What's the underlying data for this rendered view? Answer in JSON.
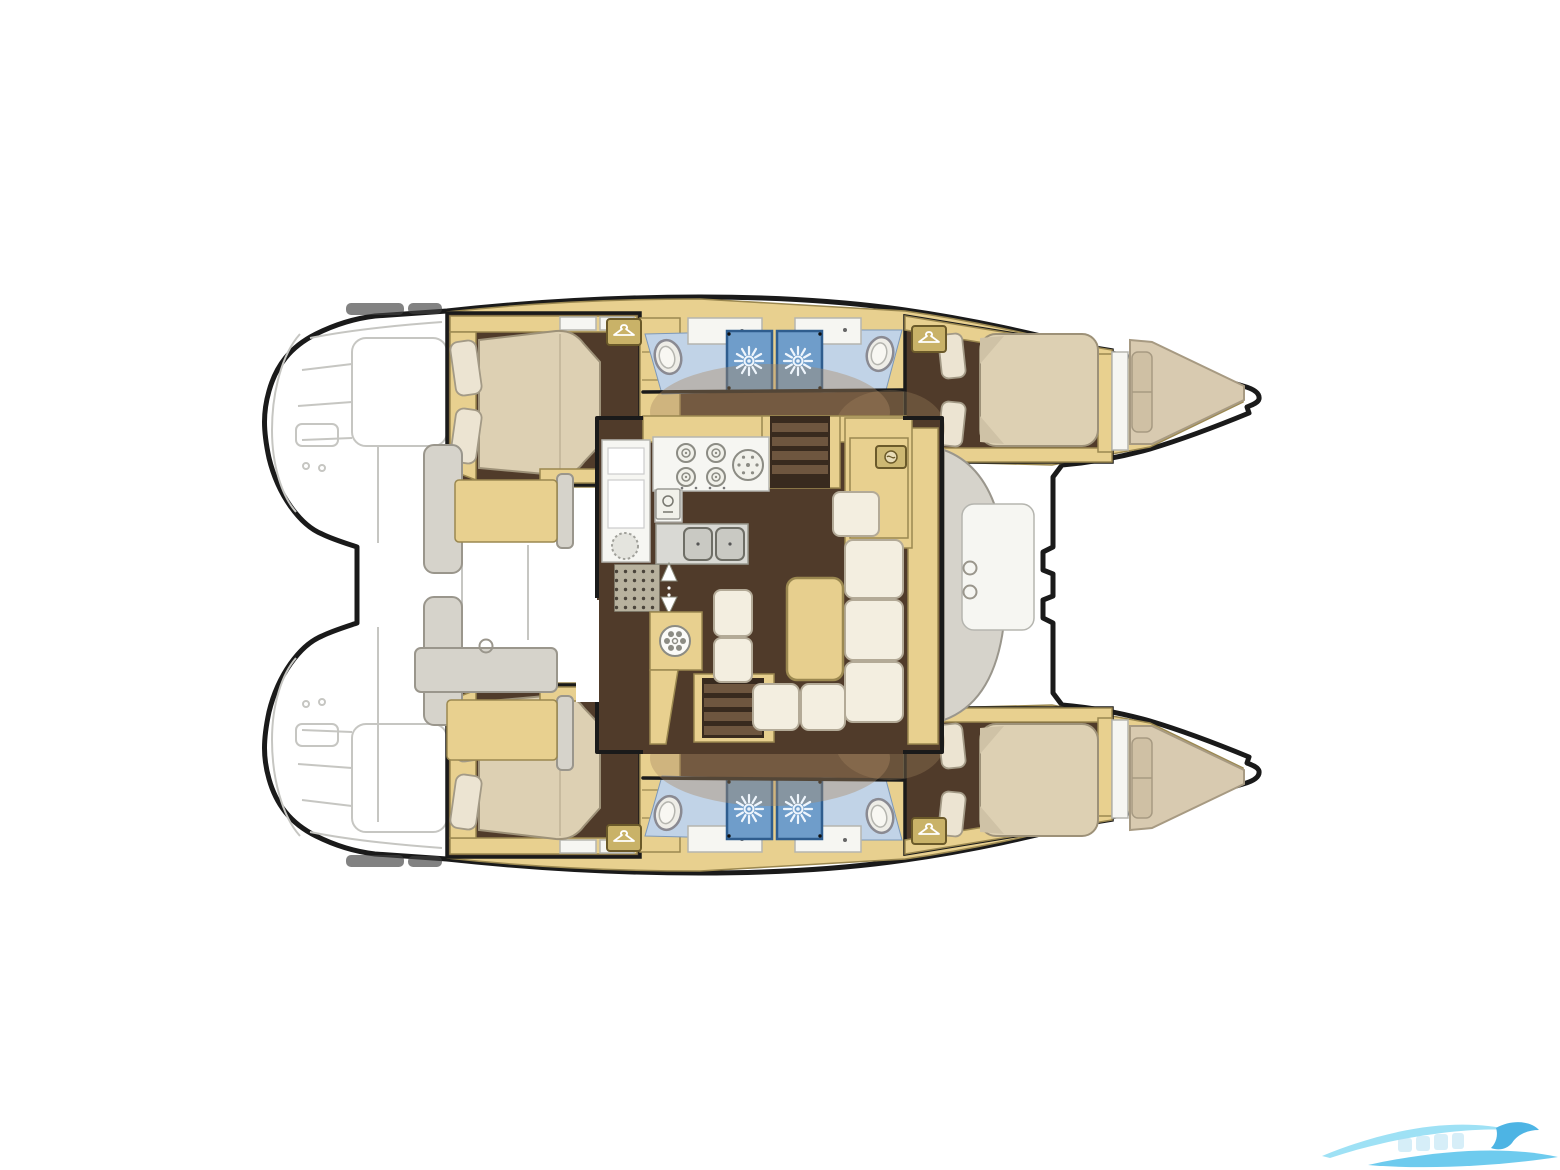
{
  "diagram": {
    "label": "Catamaran interior floor plan (top view)",
    "type": "boat-floor-plan",
    "rooms": [
      {
        "id": "port-aft-cabin",
        "label": "aft double-bed cabin (port hull)"
      },
      {
        "id": "port-aft-head",
        "label": "aft bathroom: toilet + shower stall (port hull)"
      },
      {
        "id": "port-fwd-head",
        "label": "forward bathroom: shower stall + toilet (port hull)"
      },
      {
        "id": "port-fwd-cabin",
        "label": "forward double-bed cabin (port hull)"
      },
      {
        "id": "port-forepeak",
        "label": "forepeak berth cushion (port bow)"
      },
      {
        "id": "stbd-aft-cabin",
        "label": "aft double-bed cabin (starboard hull)"
      },
      {
        "id": "stbd-aft-head",
        "label": "aft bathroom: toilet + shower stall (starboard hull)"
      },
      {
        "id": "stbd-fwd-head",
        "label": "forward bathroom: shower stall + toilet (starboard hull)"
      },
      {
        "id": "stbd-fwd-cabin",
        "label": "forward double-bed cabin (starboard hull)"
      },
      {
        "id": "stbd-forepeak",
        "label": "forepeak berth cushion (starboard bow)"
      },
      {
        "id": "saloon",
        "label": "central saloon with U-sofa and table"
      },
      {
        "id": "galley",
        "label": "galley: 4-burner stove, round sink, double sink, fridge"
      },
      {
        "id": "aft-cockpit",
        "label": "aft cockpit with benches and table (sketched)"
      },
      {
        "id": "fwd-cockpit",
        "label": "forward cockpit curved bench with table"
      },
      {
        "id": "trampoline",
        "label": "foredeck / trampoline area between bows"
      }
    ],
    "features": [
      "companionway-stairs-x2",
      "hanging-locker-icons",
      "shower-head-icons",
      "toilet-icons",
      "stove-burner-icons",
      "fridge-icon",
      "fan-icon",
      "wet-bar-icon",
      "transom-steps-sketch"
    ]
  },
  "palette": {
    "outline": "#1a1a1a",
    "sketch": "#c6c6c2",
    "hull-yellow": "#e8d08f",
    "yellow-dark": "#9b8850",
    "floor-brown": "#503b2a",
    "stair-dark": "#382a1e",
    "stair-tread": "#6e563f",
    "bed-cream": "#ddd0b3",
    "bed-edge": "#9d9178",
    "pillow": "#ece4d2",
    "counter-white": "#f6f6f2",
    "blue-floor": "#c1d3e7",
    "blue-shower": "#6f9dca",
    "blue-shower-dark": "#2f5d8e",
    "gray-sofa": "#d6d3cb",
    "gray-edge": "#9a968c",
    "sofa-cream": "#f3eee0",
    "sofa-edge": "#b3aa97",
    "arc-tan": "#a98a64",
    "wm-light": "#8edcf4",
    "wm-mid": "#55c3ec",
    "wm-dark": "#2fa8e0"
  },
  "fixtures": [
    {
      "type": "shower-head",
      "x": 749,
      "y": 361
    },
    {
      "type": "shower-head",
      "x": 798,
      "y": 361
    },
    {
      "type": "shower-head",
      "x": 749,
      "y": 809
    },
    {
      "type": "shower-head",
      "x": 798,
      "y": 809
    },
    {
      "type": "toilet",
      "x": 668,
      "y": 357,
      "rot": -14
    },
    {
      "type": "toilet",
      "x": 880,
      "y": 354,
      "rot": 14
    },
    {
      "type": "toilet",
      "x": 668,
      "y": 813,
      "rot": 14
    },
    {
      "type": "toilet",
      "x": 880,
      "y": 816,
      "rot": -14
    },
    {
      "type": "hanger",
      "x": 624,
      "y": 332
    },
    {
      "type": "hanger",
      "x": 929,
      "y": 339
    },
    {
      "type": "hanger",
      "x": 624,
      "y": 838
    },
    {
      "type": "hanger",
      "x": 929,
      "y": 831
    },
    {
      "type": "burner",
      "x": 686,
      "y": 453
    },
    {
      "type": "burner",
      "x": 716,
      "y": 453
    },
    {
      "type": "burner",
      "x": 686,
      "y": 477
    },
    {
      "type": "burner",
      "x": 716,
      "y": 477
    },
    {
      "type": "round-sink",
      "x": 748,
      "y": 465
    },
    {
      "type": "faucet",
      "x": 668,
      "y": 504
    },
    {
      "type": "fan",
      "x": 675,
      "y": 641
    },
    {
      "type": "fridge",
      "x": 625,
      "y": 546
    },
    {
      "type": "wet-bar",
      "x": 891,
      "y": 457
    },
    {
      "type": "ring",
      "x": 486,
      "y": 646
    },
    {
      "type": "ring",
      "x": 970,
      "y": 568
    },
    {
      "type": "ring",
      "x": 970,
      "y": 592
    }
  ]
}
